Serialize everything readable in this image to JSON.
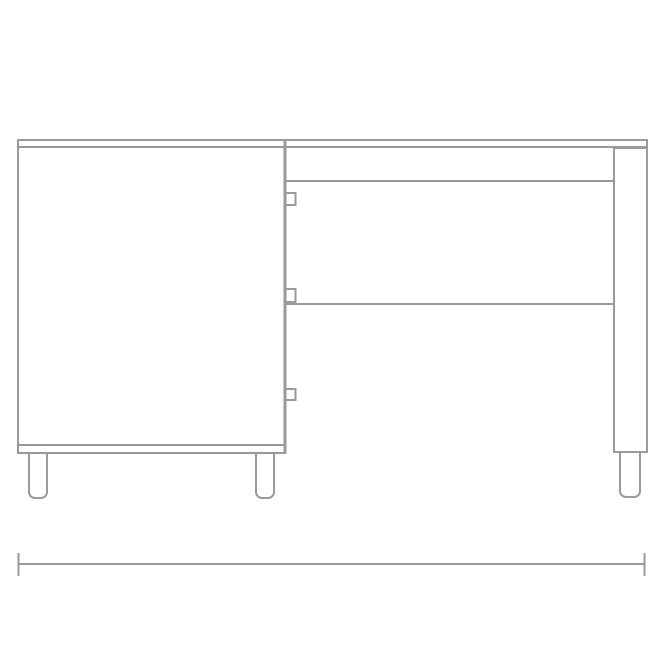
{
  "colors": {
    "background": "#ffffff",
    "line": "#9a9a9a"
  },
  "drawing": {
    "description": "Front elevation line drawing of a desk: left cabinet with door and three hinges, drawer rails in the middle section, right side panel, four legs, and an overall-width dimension line below. No text or numeric labels are shown.",
    "elements": [
      "desktop",
      "left-cabinet-side",
      "cabinet-door-panel",
      "cabinet-divider",
      "door-hinge-top",
      "door-hinge-middle",
      "door-hinge-bottom",
      "cabinet-bottom-inner-edge",
      "cabinet-bottom-outer-edge",
      "apron-rail",
      "drawer-divider",
      "drawer-front-region",
      "right-side-panel",
      "cabinet-left-leg",
      "cabinet-right-leg",
      "side-panel-leg",
      "overall-width-dimension-line"
    ],
    "dimension_label": ""
  }
}
